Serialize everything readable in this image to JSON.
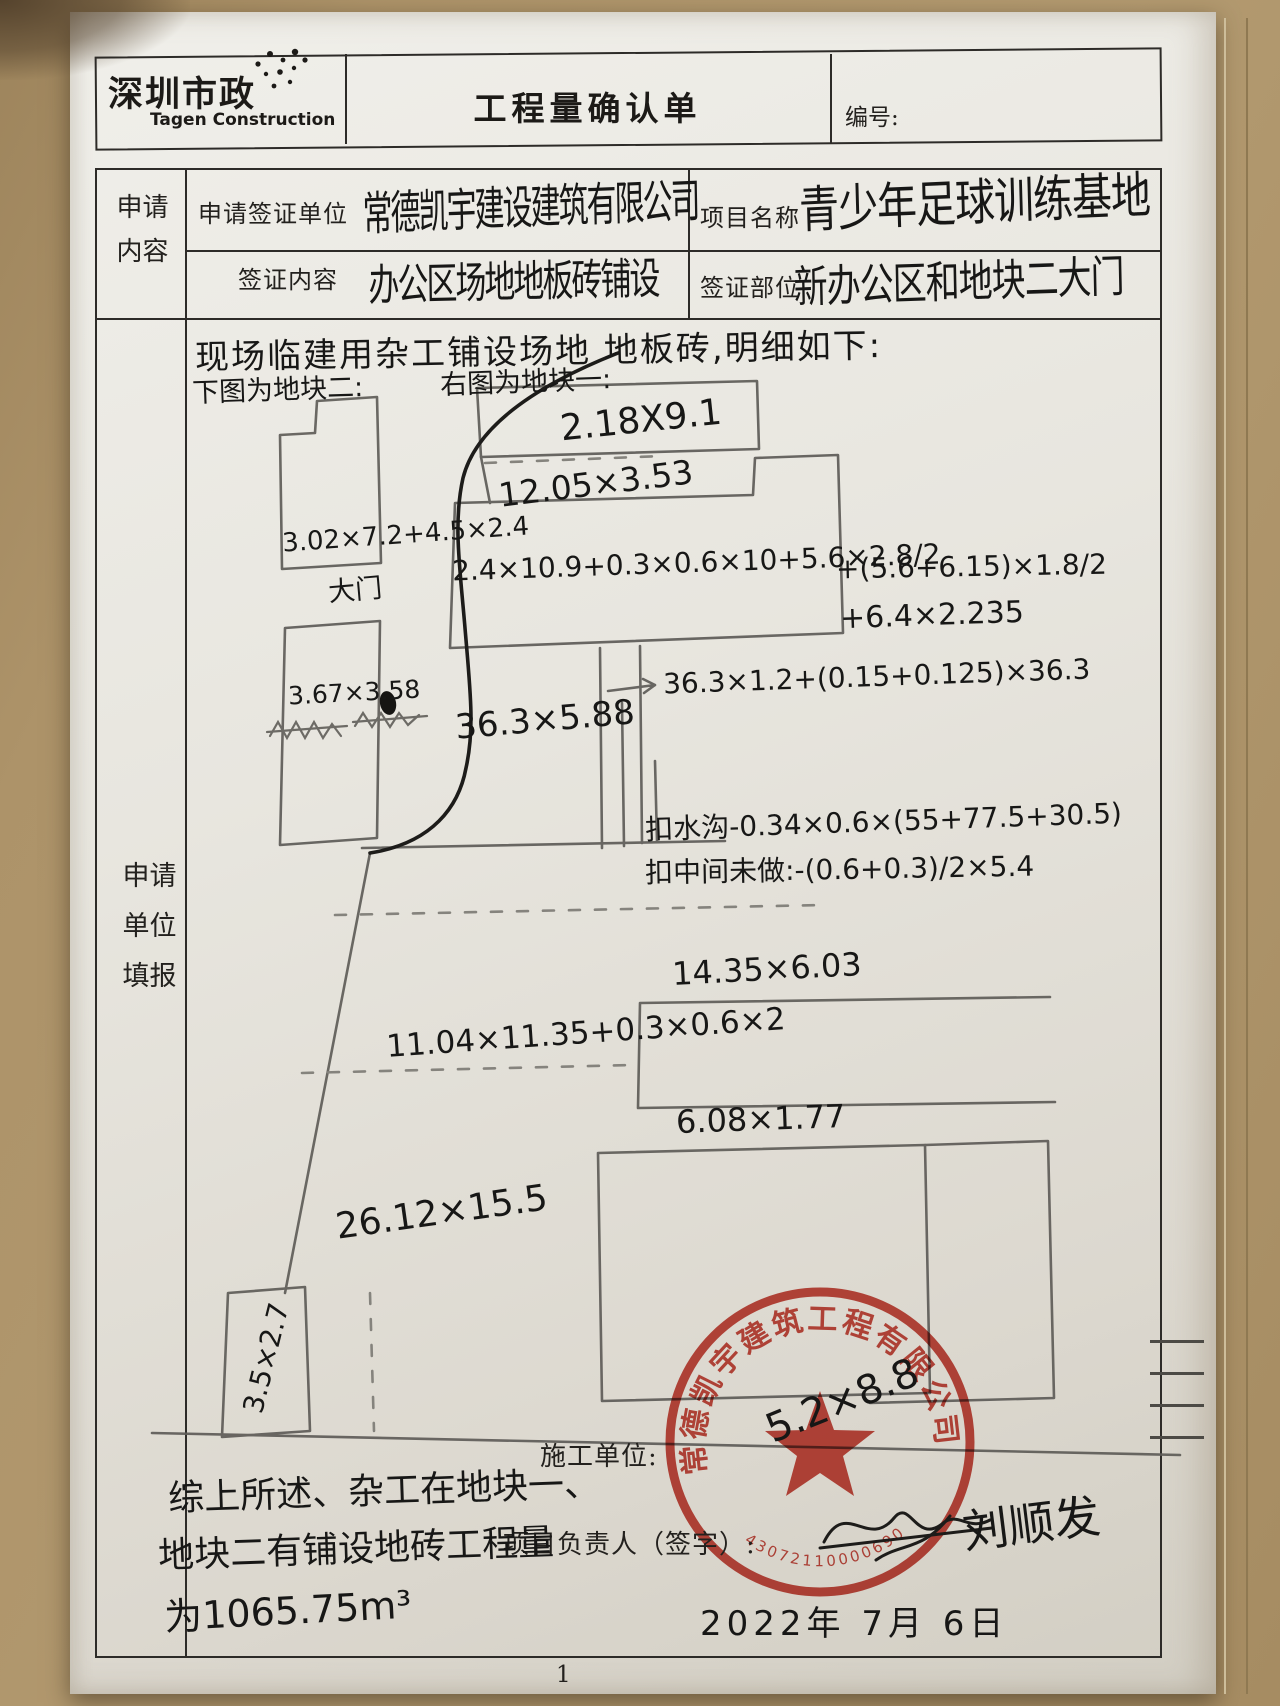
{
  "header": {
    "logo_cn": "深圳市政",
    "logo_en": "Tagen Construction",
    "title": "工程量确认单",
    "doc_no_label": "编号:"
  },
  "form": {
    "section1_label": "申请\n内容",
    "applicant_label": "申请签证单位",
    "applicant_value": "常德凯宇建设建筑有限公司",
    "project_label": "项目名称",
    "project_value": "青少年足球训练基地",
    "content_label": "签证内容",
    "content_value": "办公区场地地板砖铺设",
    "location_label": "签证部位",
    "location_value": "新办公区和地块二大门",
    "section2_label": "申请\n单位\n填报"
  },
  "sketch": {
    "intro": "现场临建用杂工铺设场地 地板砖,明细如下:",
    "left_caption": "下图为地块二:",
    "right_caption": "右图为地块一:",
    "gate_label": "大门",
    "dims": {
      "top_box": "2.18X9.1",
      "row2": "12.05×3.53",
      "block2_box1": "3.02×7.2+4.5×2.4",
      "wide_bar": "2.4×10.9+0.3×0.6×10+5.6×2.8/2",
      "wide_bar_add1": "+(5.6+6.15)×1.8/2",
      "wide_bar_add2": "+6.4×2.235",
      "block2_box2": "3.67×3.58",
      "strip": "36.3×5.88",
      "strip_arrow": "36.3×1.2+(0.15+0.125)×36.3",
      "ditch_deduct": "扣水沟-0.34×0.6×(55+77.5+30.5)",
      "middle_deduct": "扣中间未做:-(0.6+0.3)/2×5.4",
      "mid_box": "14.35×6.03",
      "mid_area": "11.04×11.35+0.3×0.6×2",
      "small_strip": "6.08×1.77",
      "big_area": "26.12×15.5",
      "corner_box": "3.5×2.7",
      "stamp_area": "5.2×8.8"
    }
  },
  "footer": {
    "contractor_label": "施工单位:",
    "manager_label": "项目负责人（签字）:",
    "signature_name": "刘顺发",
    "date": "2022年 7月 6日",
    "summary_line1": "综上所述、杂工在地块一、",
    "summary_line2": "地块二有铺设地砖工程量",
    "summary_line3": "为1065.75m³"
  },
  "stamp": {
    "company": "常德凯宇建筑工程有限公司",
    "serial": "43072110000690"
  },
  "page_number": "1",
  "colors": {
    "stamp_red": "#c23327",
    "paper": "#e8e6df",
    "desk": "#ad9369",
    "pencil": "#5e5c58",
    "ink": "#1d1c1a"
  }
}
